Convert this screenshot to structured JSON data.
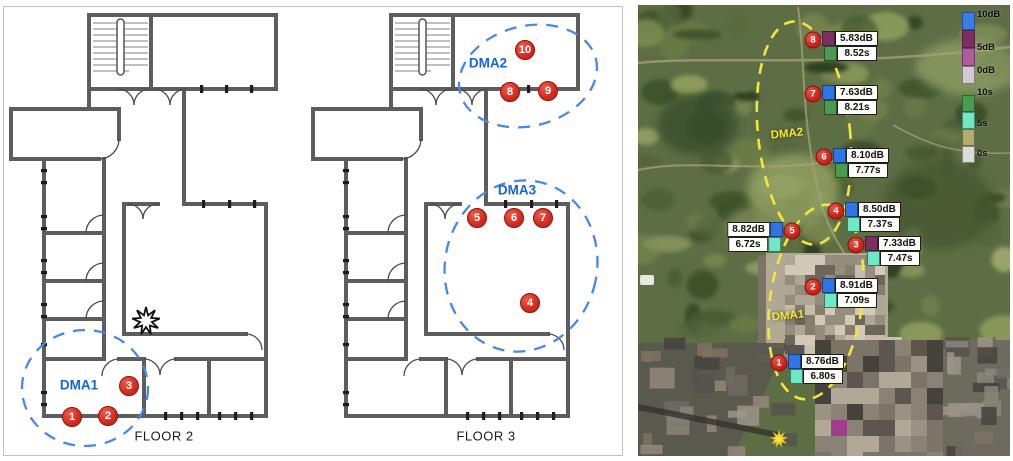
{
  "floor_plans": {
    "floor2": {
      "title": "FLOOR 2",
      "dma_label": "DMA1",
      "markers": [
        "1",
        "2",
        "3"
      ]
    },
    "floor3": {
      "title": "FLOOR 3",
      "dma_labels": [
        "DMA2",
        "DMA3"
      ],
      "markers": [
        "4",
        "5",
        "6",
        "7",
        "8",
        "9",
        "10"
      ]
    },
    "colors": {
      "zone_ellipse_blue": "#4b86e8",
      "marker_red": "#d0271b",
      "dma_text_blue": "#1565d8"
    }
  },
  "photo": {
    "region_labels": {
      "dma2": "DMA2",
      "dma1": "DMA1"
    },
    "legend_db": {
      "labels": [
        "10dB",
        "5dB",
        "0dB"
      ],
      "colors": [
        "#3a7ce8",
        "#7c2f62",
        "#b25a9e",
        "#d5c8d0"
      ]
    },
    "legend_time": {
      "labels": [
        "10s",
        "5s",
        "0s"
      ],
      "colors": [
        "#4a9b4e",
        "#6fe8c5",
        "#b3ad6d",
        "#dcdcd2"
      ]
    },
    "measurements": [
      {
        "id": "8",
        "db": "5.83dB",
        "db_color": "#7c2f62",
        "time": "8.52s",
        "time_color": "#4a9b4e"
      },
      {
        "id": "7",
        "db": "7.63dB",
        "db_color": "#2e76e8",
        "time": "8.21s",
        "time_color": "#4a9b4e"
      },
      {
        "id": "6",
        "db": "8.10dB",
        "db_color": "#2e76e8",
        "time": "7.77s",
        "time_color": "#4a9b4e"
      },
      {
        "id": "4",
        "db": "8.50dB",
        "db_color": "#2e76e8",
        "time": "7.37s",
        "time_color": "#6fe8c5"
      },
      {
        "id": "5",
        "db": "8.82dB",
        "db_color": "#2e76e8",
        "time": "6.72s",
        "time_color": "#6fe8c5"
      },
      {
        "id": "3",
        "db": "7.33dB",
        "db_color": "#7c2f62",
        "time": "7.47s",
        "time_color": "#6fe8c5"
      },
      {
        "id": "2",
        "db": "8.91dB",
        "db_color": "#2e76e8",
        "time": "7.09s",
        "time_color": "#6fe8c5"
      },
      {
        "id": "1",
        "db": "8.76dB",
        "db_color": "#2e76e8",
        "time": "6.80s",
        "time_color": "#6fe8c5"
      }
    ],
    "colors": {
      "zone_ellipse_yellow": "#f2e73c",
      "sun_icon_yellow": "#f4e733"
    }
  }
}
